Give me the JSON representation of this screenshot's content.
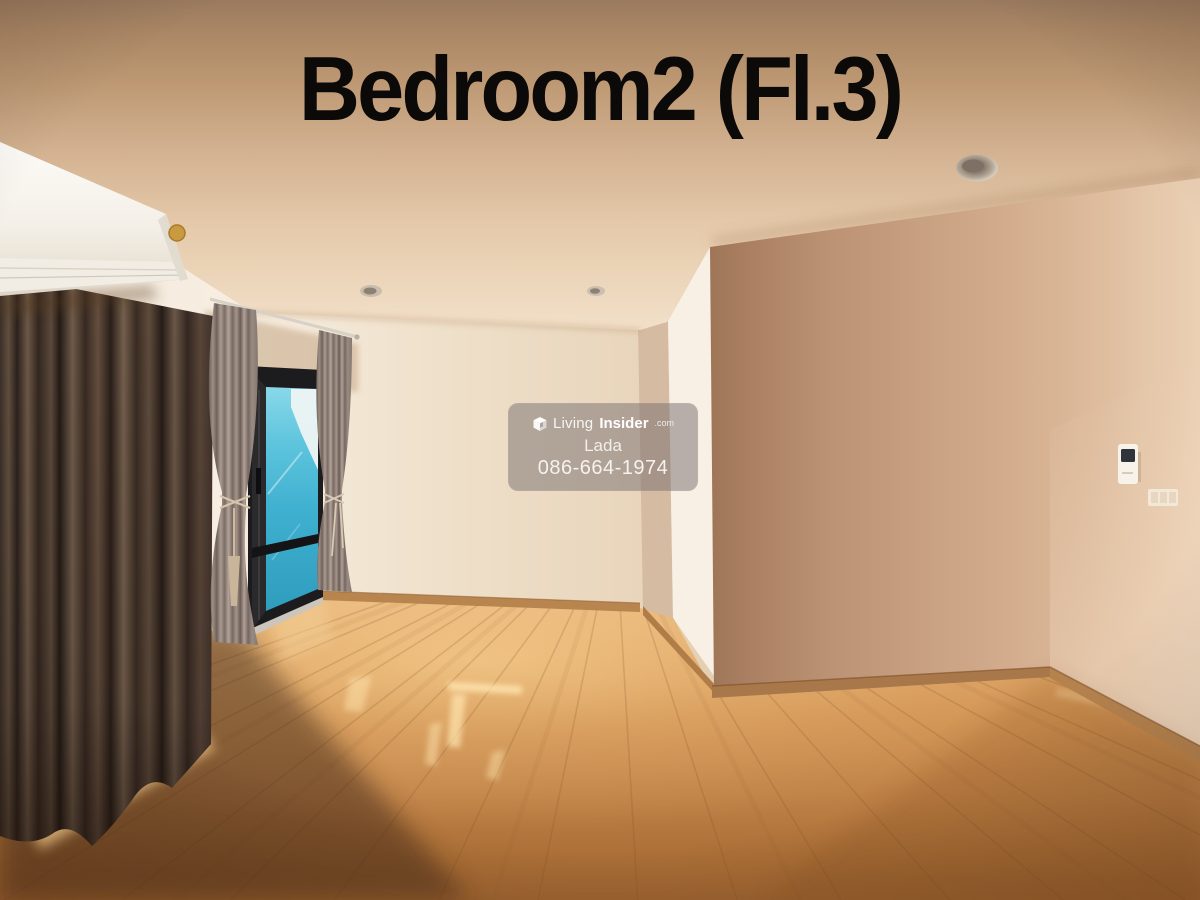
{
  "title": "Bedroom2 (Fl.3)",
  "watermark": {
    "brand_first": "Living",
    "brand_second": "Insider",
    "brand_suffix": ".com",
    "agent_name": "Lada",
    "phone": "086-664-1974"
  },
  "palette": {
    "title_color": "#0b0a08",
    "ceiling_warm": "#b08a66",
    "wall_cream": "#f2e3d2",
    "wall_shadow": "#b08969",
    "floor_wood": "#c98e55",
    "curtain_brown": "#4a3a31",
    "curtain_tieback": "#9c8d84",
    "window_glass": "#45b4d2",
    "window_frame": "#1f1f22",
    "ac_white": "#f7f4ef",
    "sun_patch": "#ffdf9e",
    "watermark_bg": "#7a7272"
  }
}
